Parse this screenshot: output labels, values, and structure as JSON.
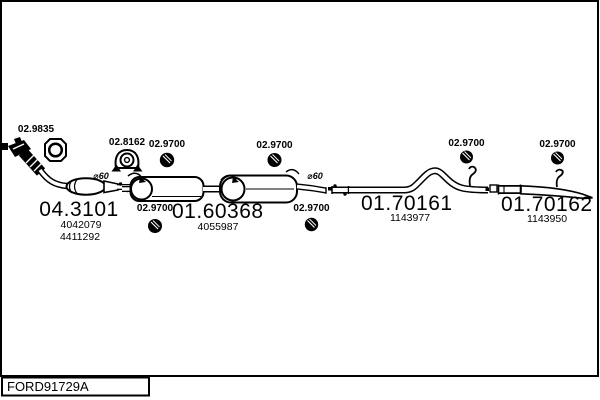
{
  "footer": {
    "drawing_code": "FORD91729A"
  },
  "annotations": {
    "pipe_diameter": "⌀60"
  },
  "fittings": {
    "flange_gasket": {
      "code": "02.9835",
      "icon": "square-gasket-icon"
    },
    "rubber_mount": {
      "code": "02.8162",
      "icon": "rubber-mount-icon"
    },
    "rubber_ring": {
      "code": "02.9700",
      "icon": "rubber-ring-icon"
    }
  },
  "parts": {
    "front_exhaust": {
      "number": "04.3101",
      "oe_refs": [
        "4042079",
        "4411292"
      ]
    },
    "centre_silencer": {
      "number": "01.60368",
      "oe_refs": [
        "4055987"
      ]
    },
    "centre_pipe": {
      "number": "01.70161",
      "oe_refs": [
        "1143977"
      ]
    },
    "tail_pipe": {
      "number": "01.70162",
      "oe_refs": [
        "1143950"
      ]
    }
  },
  "colors": {
    "line": "#000000",
    "background": "#ffffff"
  }
}
